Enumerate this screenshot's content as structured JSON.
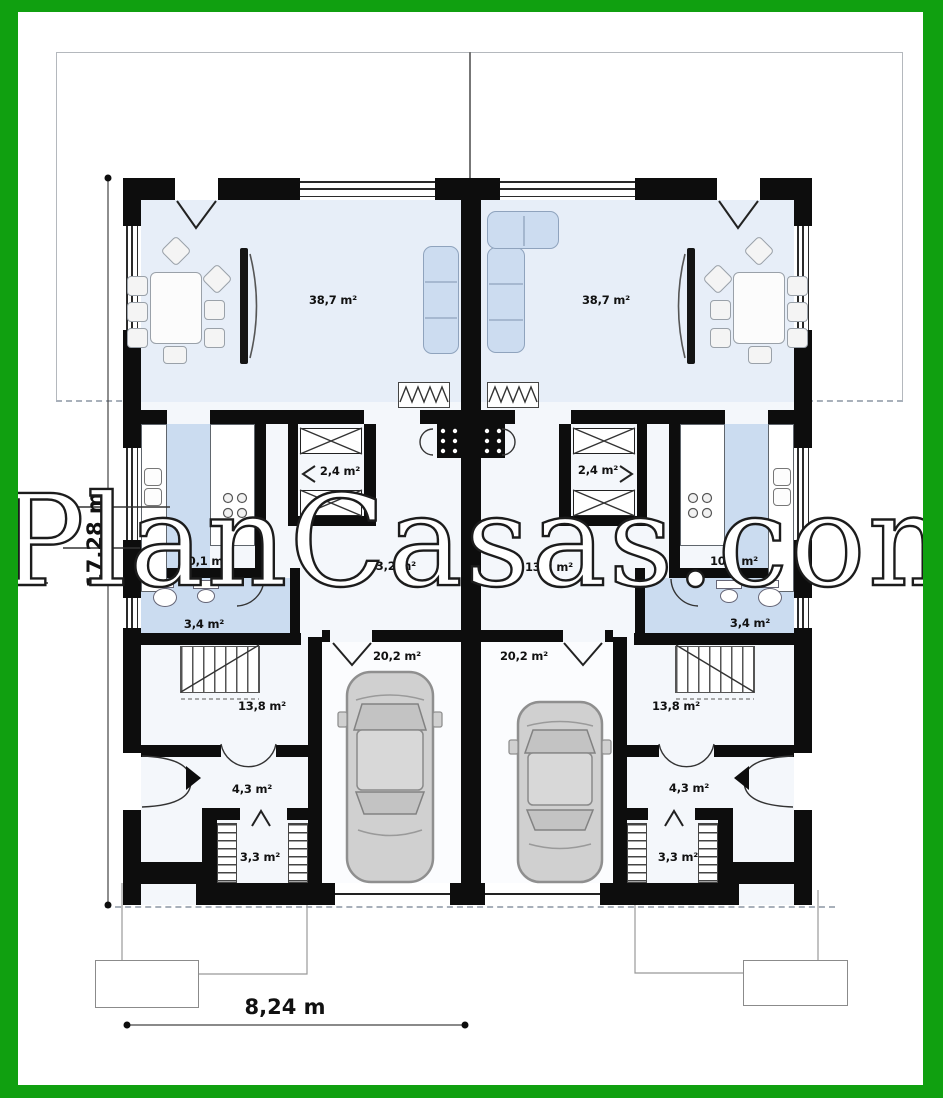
{
  "page": {
    "watermark": "PlanCasas.com",
    "type_label": "ground-floor plan of a semi-detached house"
  },
  "dimensions": {
    "height": "17,28 m",
    "width": "8,24 m"
  },
  "rooms_left": [
    {
      "name": "living-dining-room",
      "area": "38,7 m²"
    },
    {
      "name": "wardrobe",
      "area": "2,4 m²"
    },
    {
      "name": "kitchen",
      "area": "10,1 m²"
    },
    {
      "name": "hall",
      "area": "13,2 m²"
    },
    {
      "name": "bathroom",
      "area": "3,4 m²"
    },
    {
      "name": "stair-hall",
      "area": "13,8 m²"
    },
    {
      "name": "garage",
      "area": "20,2 m²"
    },
    {
      "name": "entry",
      "area": "4,3 m²"
    },
    {
      "name": "storage",
      "area": "3,3 m²"
    }
  ],
  "rooms_right": [
    {
      "name": "living-dining-room",
      "area": "38,7 m²"
    },
    {
      "name": "wardrobe",
      "area": "2,4 m²"
    },
    {
      "name": "kitchen",
      "area": "10,1 m²"
    },
    {
      "name": "hall",
      "area": "13,2 m²"
    },
    {
      "name": "bathroom",
      "area": "3,4 m²"
    },
    {
      "name": "stair-hall",
      "area": "13,8 m²"
    },
    {
      "name": "garage",
      "area": "20,2 m²"
    },
    {
      "name": "entry",
      "area": "4,3 m²"
    },
    {
      "name": "storage",
      "area": "3,3 m²"
    }
  ],
  "colors": {
    "frame_green": "#10a010",
    "wall_black": "#0d0d0d",
    "wet_area_blue": "#cbdcf0",
    "floor_tint": "#e7eef8",
    "car_gray": "#d0d0d0"
  }
}
